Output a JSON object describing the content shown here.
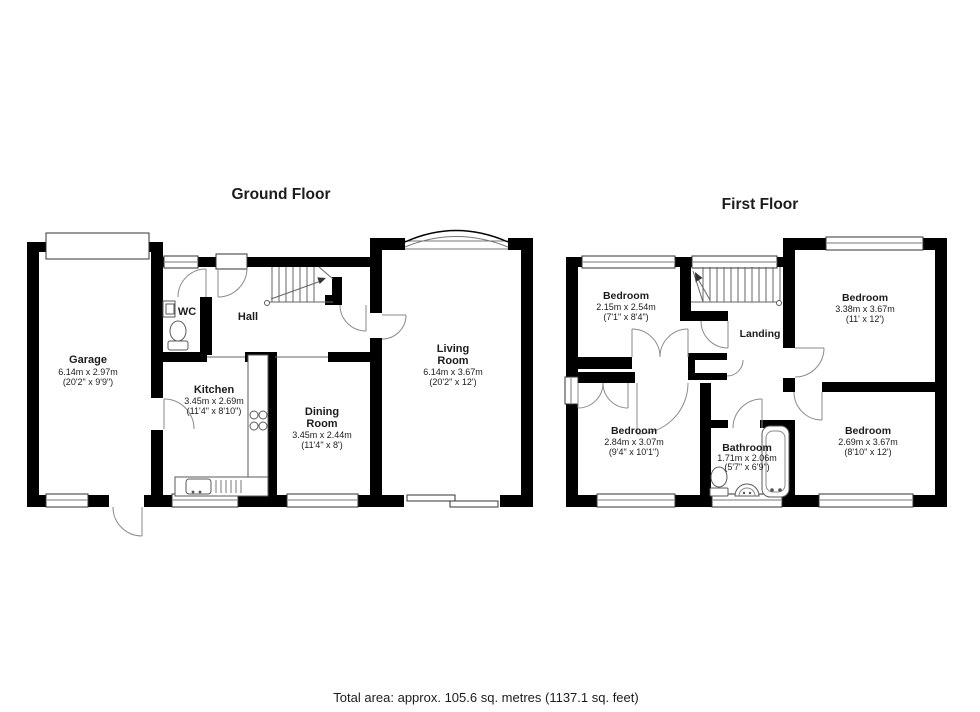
{
  "titles": {
    "ground_floor": "Ground Floor",
    "first_floor": "First Floor"
  },
  "footer": {
    "total_area": "Total area: approx. 105.6 sq. metres (1137.1 sq. feet)"
  },
  "ground_floor": {
    "rooms": {
      "garage": {
        "name": "Garage",
        "dims_m": "6.14m x 2.97m",
        "dims_ft": "(20'2\" x 9'9\")"
      },
      "kitchen": {
        "name": "Kitchen",
        "dims_m": "3.45m x 2.69m",
        "dims_ft": "(11'4\" x 8'10\")"
      },
      "dining": {
        "name_lines": [
          "Dining",
          "Room"
        ],
        "dims_m": "3.45m x 2.44m",
        "dims_ft": "(11'4\" x 8')"
      },
      "living": {
        "name_lines": [
          "Living",
          "Room"
        ],
        "dims_m": "6.14m x 3.67m",
        "dims_ft": "(20'2\" x 12')"
      },
      "wc": {
        "name": "WC"
      },
      "hall": {
        "name": "Hall"
      }
    }
  },
  "first_floor": {
    "rooms": {
      "bedroom_top_left": {
        "name": "Bedroom",
        "dims_m": "2.15m x 2.54m",
        "dims_ft": "(7'1\" x 8'4\")"
      },
      "bedroom_top_right": {
        "name": "Bedroom",
        "dims_m": "3.38m x 3.67m",
        "dims_ft": "(11' x 12')"
      },
      "bedroom_bottom_left": {
        "name": "Bedroom",
        "dims_m": "2.84m x 3.07m",
        "dims_ft": "(9'4\" x 10'1\")"
      },
      "bathroom": {
        "name": "Bathroom",
        "dims_m": "1.71m x 2.06m",
        "dims_ft": "(5'7\" x 6'9\")"
      },
      "bedroom_bottom_right": {
        "name": "Bedroom",
        "dims_m": "2.69m x 3.67m",
        "dims_ft": "(8'10\" x 12')"
      },
      "landing": {
        "name": "Landing"
      }
    }
  }
}
